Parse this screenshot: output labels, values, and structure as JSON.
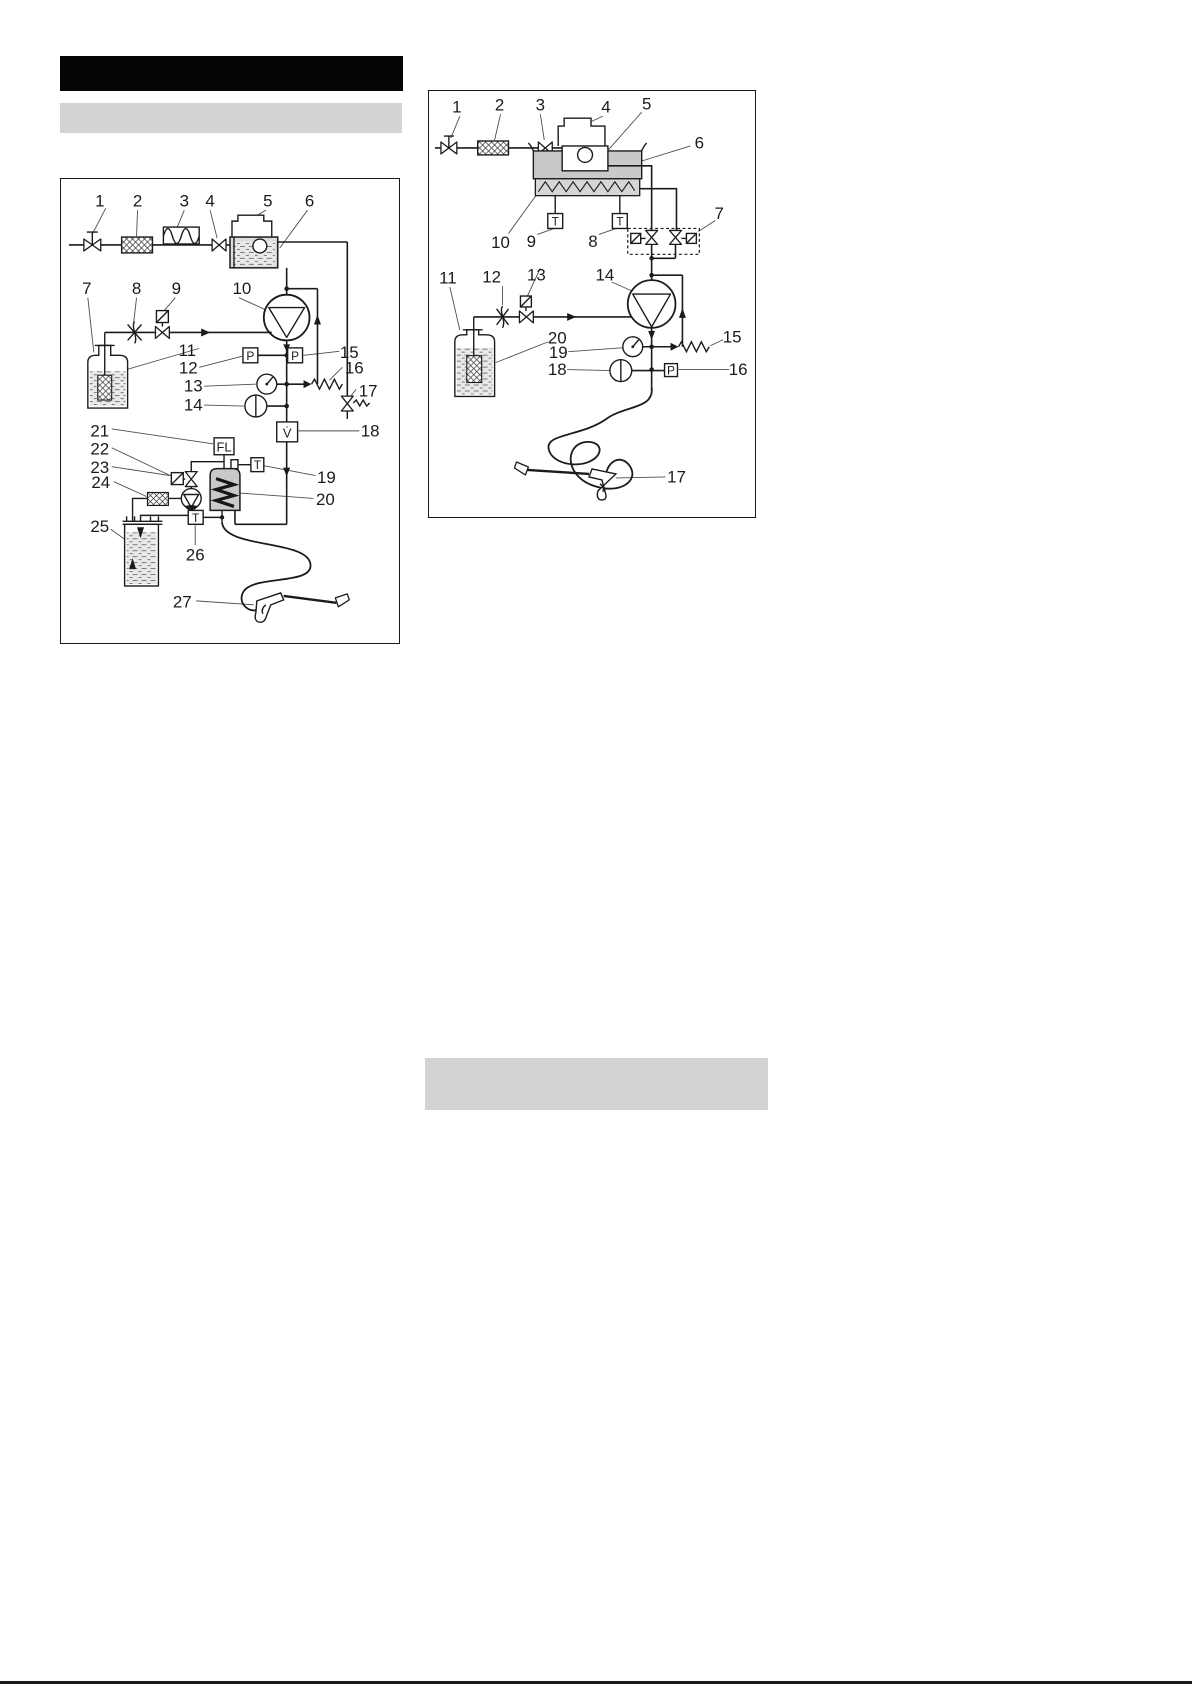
{
  "page": {
    "colors": {
      "title_bar": "#050505",
      "heading_bar": "#d3d3d3",
      "tank_gray": "#c9c9c9",
      "heater_gray": "#c9c9c9",
      "line_black": "#1b1b1b"
    }
  },
  "diagram_left": {
    "callouts": [
      "1",
      "2",
      "3",
      "4",
      "5",
      "6",
      "7",
      "8",
      "9",
      "10",
      "11",
      "12",
      "13",
      "14",
      "15",
      "16",
      "17",
      "18",
      "19",
      "20",
      "21",
      "22",
      "23",
      "24",
      "25",
      "26",
      "27"
    ],
    "sensors": {
      "pressure_left": "P",
      "pressure_right": "P",
      "flame_monitor": "FL",
      "flow_volume": "V̇",
      "temp_heater": "T",
      "temp_outlet": "T"
    }
  },
  "diagram_right": {
    "callouts": [
      "1",
      "2",
      "3",
      "4",
      "5",
      "6",
      "7",
      "8",
      "9",
      "10",
      "11",
      "12",
      "13",
      "14",
      "15",
      "16",
      "17",
      "18",
      "19",
      "20"
    ],
    "sensors": {
      "temp_left": "T",
      "temp_right": "T",
      "pressure": "P"
    }
  }
}
